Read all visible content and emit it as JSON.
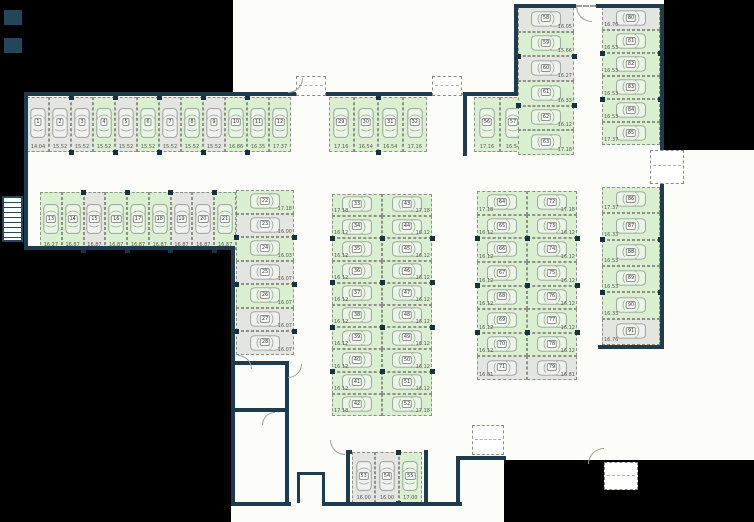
{
  "plan": {
    "type": "parking-garage-floor-plan",
    "colors": {
      "available_stall": "#d9efcf",
      "occupied_stall": "#e4e4e1",
      "wall": "#1e3c4e",
      "outside": "#000000",
      "car_outline": "#9aa29a"
    },
    "groups": [
      {
        "id": "row1",
        "stalls": [
          {
            "n": "1",
            "d": "14.04",
            "free": false
          },
          {
            "n": "2",
            "d": "15.52",
            "free": false
          },
          {
            "n": "3",
            "d": "15.52",
            "free": false
          },
          {
            "n": "4",
            "d": "15.52",
            "free": true
          },
          {
            "n": "5",
            "d": "15.52",
            "free": false
          },
          {
            "n": "6",
            "d": "15.52",
            "free": true
          },
          {
            "n": "7",
            "d": "15.52",
            "free": false
          },
          {
            "n": "8",
            "d": "15.52",
            "free": true
          },
          {
            "n": "9",
            "d": "15.52",
            "free": false
          },
          {
            "n": "10",
            "d": "16.86",
            "free": true
          },
          {
            "n": "11",
            "d": "16.35",
            "free": true
          },
          {
            "n": "12",
            "d": "17.37",
            "free": true
          }
        ]
      },
      {
        "id": "row2",
        "stalls": [
          {
            "n": "13",
            "d": "16.27",
            "free": true
          },
          {
            "n": "14",
            "d": "16.87",
            "free": true
          },
          {
            "n": "15",
            "d": "16.87",
            "free": false
          },
          {
            "n": "16",
            "d": "16.87",
            "free": true
          },
          {
            "n": "17",
            "d": "16.87",
            "free": true
          },
          {
            "n": "18",
            "d": "16.87",
            "free": true
          },
          {
            "n": "19",
            "d": "16.87",
            "free": false
          },
          {
            "n": "20",
            "d": "16.87",
            "free": false
          },
          {
            "n": "21",
            "d": "16.87",
            "free": true
          }
        ]
      },
      {
        "id": "colC",
        "stalls": [
          {
            "n": "22",
            "d": "17.18",
            "free": true
          },
          {
            "n": "23",
            "d": "16.00",
            "free": false
          },
          {
            "n": "24",
            "d": "16.03",
            "free": true
          },
          {
            "n": "25",
            "d": "16.07",
            "free": false
          },
          {
            "n": "26",
            "d": "16.07",
            "free": true
          },
          {
            "n": "27",
            "d": "16.07",
            "free": false
          },
          {
            "n": "28",
            "d": "16.07",
            "free": false
          }
        ]
      },
      {
        "id": "rowD",
        "stalls": [
          {
            "n": "29",
            "d": "17.16",
            "free": true
          },
          {
            "n": "30",
            "d": "16.54",
            "free": true
          },
          {
            "n": "31",
            "d": "16.54",
            "free": true
          },
          {
            "n": "32",
            "d": "17.16",
            "free": true
          }
        ]
      },
      {
        "id": "midL",
        "stalls": [
          {
            "n": "33",
            "d": "17.18",
            "free": true
          },
          {
            "n": "34",
            "d": "16.12",
            "free": true
          },
          {
            "n": "35",
            "d": "16.12",
            "free": true
          },
          {
            "n": "36",
            "d": "16.12",
            "free": true
          },
          {
            "n": "37",
            "d": "16.12",
            "free": true
          },
          {
            "n": "38",
            "d": "16.12",
            "free": true
          },
          {
            "n": "39",
            "d": "16.12",
            "free": true
          },
          {
            "n": "40",
            "d": "16.12",
            "free": true
          },
          {
            "n": "41",
            "d": "16.12",
            "free": true
          },
          {
            "n": "42",
            "d": "17.18",
            "free": true
          }
        ]
      },
      {
        "id": "midR",
        "stalls": [
          {
            "n": "43",
            "d": "17.18",
            "free": true
          },
          {
            "n": "44",
            "d": "16.12",
            "free": true
          },
          {
            "n": "45",
            "d": "16.12",
            "free": true
          },
          {
            "n": "46",
            "d": "16.12",
            "free": true
          },
          {
            "n": "47",
            "d": "16.12",
            "free": true
          },
          {
            "n": "48",
            "d": "16.12",
            "free": true
          },
          {
            "n": "49",
            "d": "16.12",
            "free": true
          },
          {
            "n": "50",
            "d": "16.12",
            "free": true
          },
          {
            "n": "51",
            "d": "16.12",
            "free": true
          },
          {
            "n": "52",
            "d": "17.18",
            "free": true
          }
        ]
      },
      {
        "id": "botC",
        "stalls": [
          {
            "n": "53",
            "d": "16.00",
            "free": false
          },
          {
            "n": "54",
            "d": "16.00",
            "free": false
          },
          {
            "n": "55",
            "d": "17.00",
            "free": true
          }
        ]
      },
      {
        "id": "tr",
        "stalls": [
          {
            "n": "56",
            "d": "17.16",
            "free": true
          },
          {
            "n": "57",
            "d": "16.54",
            "free": true
          }
        ]
      },
      {
        "id": "colE",
        "stalls": [
          {
            "n": "58",
            "d": "16.05",
            "free": false
          },
          {
            "n": "59",
            "d": "15.66",
            "free": true
          },
          {
            "n": "60",
            "d": "16.27",
            "free": false
          },
          {
            "n": "61",
            "d": "16.33",
            "free": true
          },
          {
            "n": "62",
            "d": "16.12",
            "free": true
          },
          {
            "n": "63",
            "d": "17.18",
            "free": true
          }
        ]
      },
      {
        "id": "colF",
        "stalls": [
          {
            "n": "80",
            "d": "16.76",
            "free": false
          },
          {
            "n": "81",
            "d": "16.53",
            "free": true
          },
          {
            "n": "82",
            "d": "16.53",
            "free": true
          },
          {
            "n": "83",
            "d": "16.53",
            "free": true
          },
          {
            "n": "84",
            "d": "16.53",
            "free": true
          },
          {
            "n": "85",
            "d": "17.37",
            "free": true
          }
        ]
      },
      {
        "id": "rmL",
        "stalls": [
          {
            "n": "64",
            "d": "17.18",
            "free": true
          },
          {
            "n": "65",
            "d": "16.12",
            "free": true
          },
          {
            "n": "66",
            "d": "16.12",
            "free": true
          },
          {
            "n": "67",
            "d": "16.12",
            "free": true
          },
          {
            "n": "68",
            "d": "16.12",
            "free": true
          },
          {
            "n": "69",
            "d": "16.12",
            "free": true
          },
          {
            "n": "70",
            "d": "16.12",
            "free": true
          },
          {
            "n": "71",
            "d": "16.81",
            "free": false
          }
        ]
      },
      {
        "id": "rmR",
        "stalls": [
          {
            "n": "72",
            "d": "17.18",
            "free": true
          },
          {
            "n": "73",
            "d": "16.12",
            "free": true
          },
          {
            "n": "74",
            "d": "16.12",
            "free": true
          },
          {
            "n": "75",
            "d": "16.12",
            "free": true
          },
          {
            "n": "76",
            "d": "16.12",
            "free": true
          },
          {
            "n": "77",
            "d": "16.12",
            "free": true
          },
          {
            "n": "78",
            "d": "16.12",
            "free": true
          },
          {
            "n": "79",
            "d": "16.81",
            "free": false
          }
        ]
      },
      {
        "id": "colG",
        "stalls": [
          {
            "n": "86",
            "d": "17.37",
            "free": true
          },
          {
            "n": "87",
            "d": "16.33",
            "free": true
          },
          {
            "n": "88",
            "d": "16.53",
            "free": true
          },
          {
            "n": "89",
            "d": "16.53",
            "free": true
          },
          {
            "n": "90",
            "d": "16.33",
            "free": true
          },
          {
            "n": "91",
            "d": "16.76",
            "free": false
          }
        ]
      }
    ]
  }
}
